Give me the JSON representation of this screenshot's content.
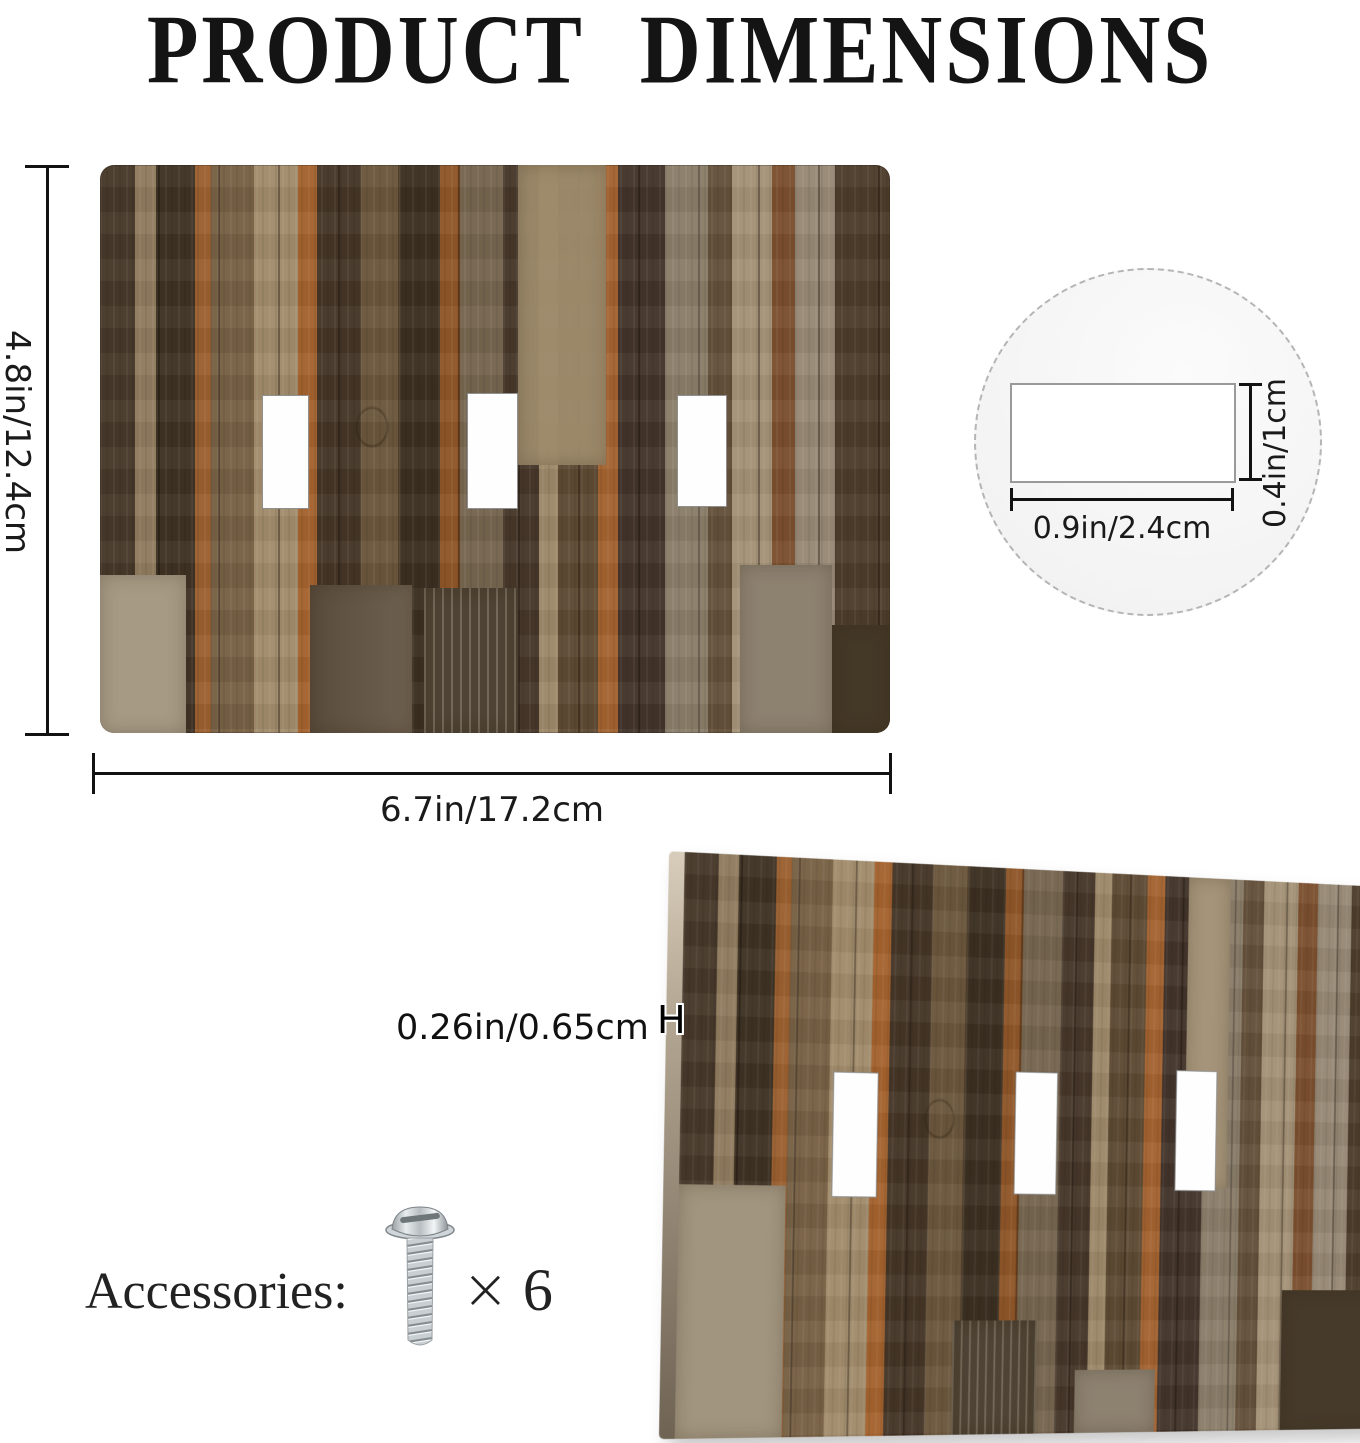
{
  "title": "PRODUCT DIMENSIONS",
  "front_view": {
    "height_label": "4.8in/12.4cm",
    "width_label": "6.7in/17.2cm",
    "toggle_hole_count": 3
  },
  "hole_detail": {
    "width_label": "0.9in/2.4cm",
    "height_label": "0.4in/1cm"
  },
  "side_view": {
    "thickness_label": "0.26in/0.65cm",
    "thickness_marker": "H",
    "toggle_hole_count": 3
  },
  "accessories": {
    "label": "Accessories:",
    "item": "screw",
    "multiplier": "×",
    "count": "6"
  },
  "colors": {
    "text": "#161616",
    "dimension_line": "#121212",
    "detail_circle_fill": "#f5f5f5",
    "detail_circle_border": "#b5b5b5",
    "wood_dark_brown": "#42342a",
    "wood_medium_brown": "#6b563c",
    "wood_tan": "#a39176",
    "wood_rust": "#a4622e",
    "wood_gray": "#8a7d6a",
    "plate_edge_light": "#cfc3ae",
    "hole_fill": "#ffffff"
  }
}
